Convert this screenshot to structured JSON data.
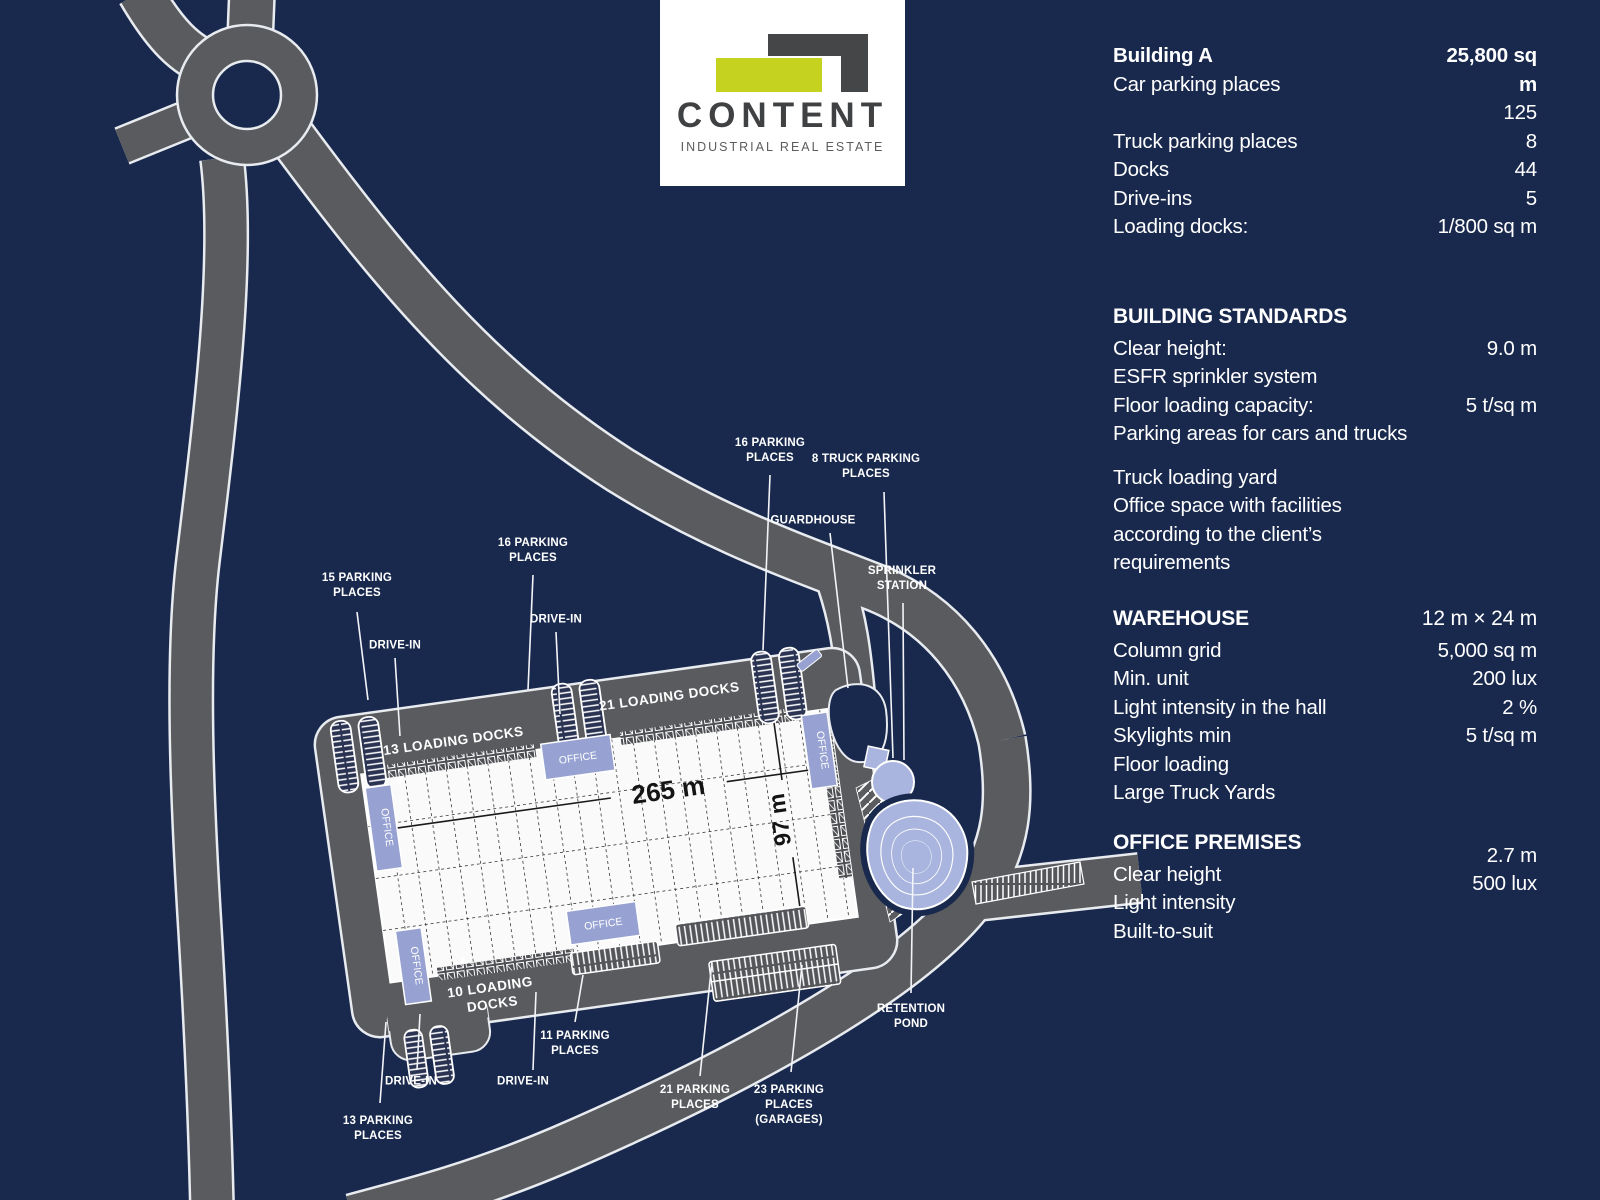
{
  "colors": {
    "background": "#19294d",
    "road_gray": "#595b5e",
    "road_outline": "#e8ebef",
    "building_white": "#fafafa",
    "office_lavender": "#97a2d2",
    "pond_lavender": "#a9b5de",
    "logo_lime": "#c5d21f",
    "logo_dark_gray": "#454648",
    "text_white": "#ffffff"
  },
  "logo": {
    "name": "CONTENT",
    "tagline": "INDUSTRIAL REAL ESTATE"
  },
  "map": {
    "dim_length": "265 m",
    "dim_width": "97 m",
    "office_label": "OFFICE",
    "area_labels": {
      "docks13": "13 LOADING DOCKS",
      "docks21": "21 LOADING DOCKS",
      "docks10_l1": "10 LOADING",
      "docks10_l2": "DOCKS"
    },
    "callouts": [
      {
        "id": "parking-15",
        "text": "15 PARKING\nPLACES",
        "x": 357,
        "y": 586,
        "line": [
          357,
          612,
          368,
          700
        ]
      },
      {
        "id": "drive-in-nw",
        "text": "DRIVE-IN",
        "x": 395,
        "y": 646,
        "line": [
          395,
          658,
          400,
          736
        ]
      },
      {
        "id": "parking-16-mid",
        "text": "16 PARKING\nPLACES",
        "x": 533,
        "y": 551,
        "line": [
          533,
          575,
          528,
          690
        ]
      },
      {
        "id": "drive-in-mid",
        "text": "DRIVE-IN",
        "x": 556,
        "y": 620,
        "line": [
          556,
          632,
          560,
          714
        ]
      },
      {
        "id": "parking-16-ne",
        "text": "16 PARKING\nPLACES",
        "x": 770,
        "y": 451,
        "line": [
          770,
          475,
          763,
          650
        ]
      },
      {
        "id": "truck-parking-8",
        "text": "8 TRUCK PARKING\nPLACES",
        "x": 866,
        "y": 467,
        "line": [
          884,
          492,
          893,
          758
        ]
      },
      {
        "id": "guardhouse",
        "text": "GUARDHOUSE",
        "x": 813,
        "y": 521,
        "line": [
          830,
          533,
          848,
          688
        ]
      },
      {
        "id": "sprinkler-station",
        "text": "SPRINKLER\nSTATION",
        "x": 902,
        "y": 579,
        "line": [
          903,
          603,
          904,
          760
        ]
      },
      {
        "id": "retention-pond",
        "text": "RETENTION\nPOND",
        "x": 911,
        "y": 1017,
        "line": [
          911,
          993,
          913,
          868
        ]
      },
      {
        "id": "parking-13",
        "text": "13 PARKING\nPLACES",
        "x": 378,
        "y": 1129,
        "line": [
          380,
          1103,
          386,
          1022
        ]
      },
      {
        "id": "drive-in-sw",
        "text": "DRIVE-IN",
        "x": 411,
        "y": 1082,
        "line": [
          417,
          1070,
          420,
          1014
        ]
      },
      {
        "id": "drive-in-s",
        "text": "DRIVE-IN",
        "x": 523,
        "y": 1082,
        "line": [
          533,
          1070,
          536,
          992
        ]
      },
      {
        "id": "parking-11",
        "text": "11 PARKING\nPLACES",
        "x": 575,
        "y": 1044,
        "line": [
          575,
          1022,
          583,
          975
        ]
      },
      {
        "id": "parking-21",
        "text": "21 PARKING\nPLACES",
        "x": 695,
        "y": 1098,
        "line": [
          700,
          1076,
          712,
          962
        ]
      },
      {
        "id": "parking-23",
        "text": "23 PARKING\nPLACES\n(GARAGES)",
        "x": 789,
        "y": 1106,
        "line": [
          791,
          1072,
          802,
          965
        ]
      }
    ]
  },
  "panel": {
    "sections": [
      {
        "id": "building-a",
        "gap": "lg",
        "rows": [
          {
            "label": "Building A",
            "value": "25,800 sq m",
            "bold": true
          },
          {
            "label": "Car parking places",
            "value": "",
            "pull_up": true
          },
          {
            "label": "",
            "value": "125"
          },
          {
            "label": "Truck parking places",
            "value": "8"
          },
          {
            "label": "Docks",
            "value": "44"
          },
          {
            "label": "Drive-ins",
            "value": "5"
          },
          {
            "label": "Loading docks:",
            "value": "1/800 sq m"
          }
        ]
      },
      {
        "id": "building-standards",
        "heading": "BUILDING STANDARDS",
        "gap": "md",
        "rows": [
          {
            "label": "Clear height:",
            "value": "9.0 m"
          },
          {
            "label": "ESFR sprinkler system",
            "value": ""
          },
          {
            "label": "Floor loading capacity:",
            "value": "5 t/sq m"
          },
          {
            "label": "Parking areas for cars and trucks",
            "value": ""
          },
          {
            "label": "",
            "value": "",
            "spacer": true
          },
          {
            "label": "Truck loading yard",
            "value": ""
          },
          {
            "label": "Office space with facilities according to the client’s requirements",
            "value": ""
          }
        ]
      },
      {
        "id": "warehouse",
        "heading": "WAREHOUSE",
        "heading_value": "12 m × 24 m",
        "gap": "sm",
        "rows": [
          {
            "label": "Column grid",
            "value": "5,000 sq m"
          },
          {
            "label": "Min. unit",
            "value": "200 lux"
          },
          {
            "label": "Light intensity in the hall",
            "value": "2 %"
          },
          {
            "label": "Skylights min",
            "value": "5 t/sq m"
          },
          {
            "label": "Floor loading",
            "value": ""
          },
          {
            "label": "Large Truck Yards",
            "value": ""
          }
        ]
      },
      {
        "id": "office-premises",
        "heading": "OFFICE PREMISES",
        "gap": "sm",
        "rows": [
          {
            "label": "Clear height",
            "value": "2.7 m",
            "value_shift": true
          },
          {
            "label": "Light intensity",
            "value": "500 lux",
            "value_shift": true
          },
          {
            "label": "Built-to-suit",
            "value": ""
          }
        ]
      }
    ]
  }
}
